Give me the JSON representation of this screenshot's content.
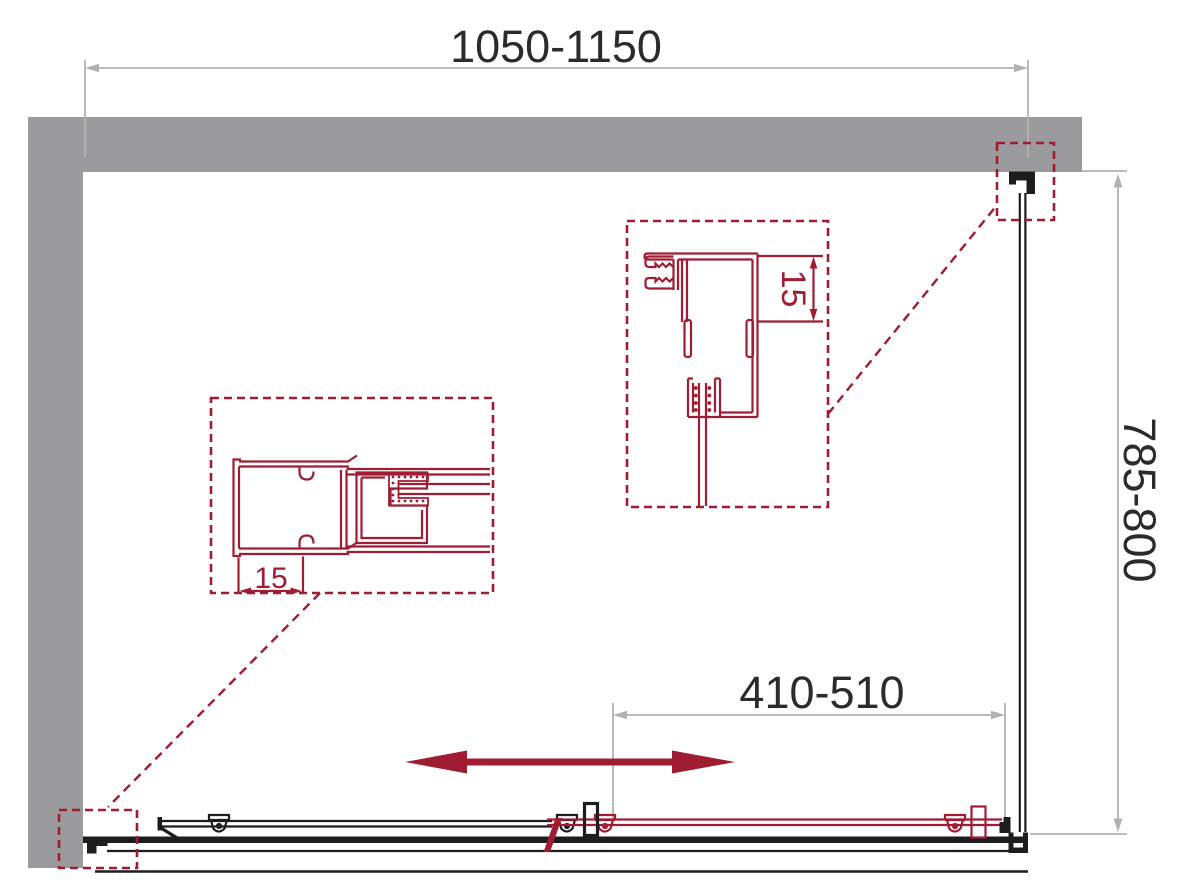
{
  "figure": {
    "type": "technical-drawing",
    "subject": "corner shower enclosure with sliding door - plan view with profile detail callouts",
    "dimension_labels": {
      "overall_width": "1050-1150",
      "side_depth": "785-800",
      "door_opening": "410-510",
      "left_detail_offset": "15",
      "wall_profile_adjustment": "15"
    },
    "colors": {
      "wall": "#9b9b9d",
      "dimension_lines": "#b2b2b2",
      "label_text": "#2b2b2b",
      "accent_red": "#a01c33",
      "profile_black": "#1d1d1f",
      "background": "#ffffff"
    }
  }
}
